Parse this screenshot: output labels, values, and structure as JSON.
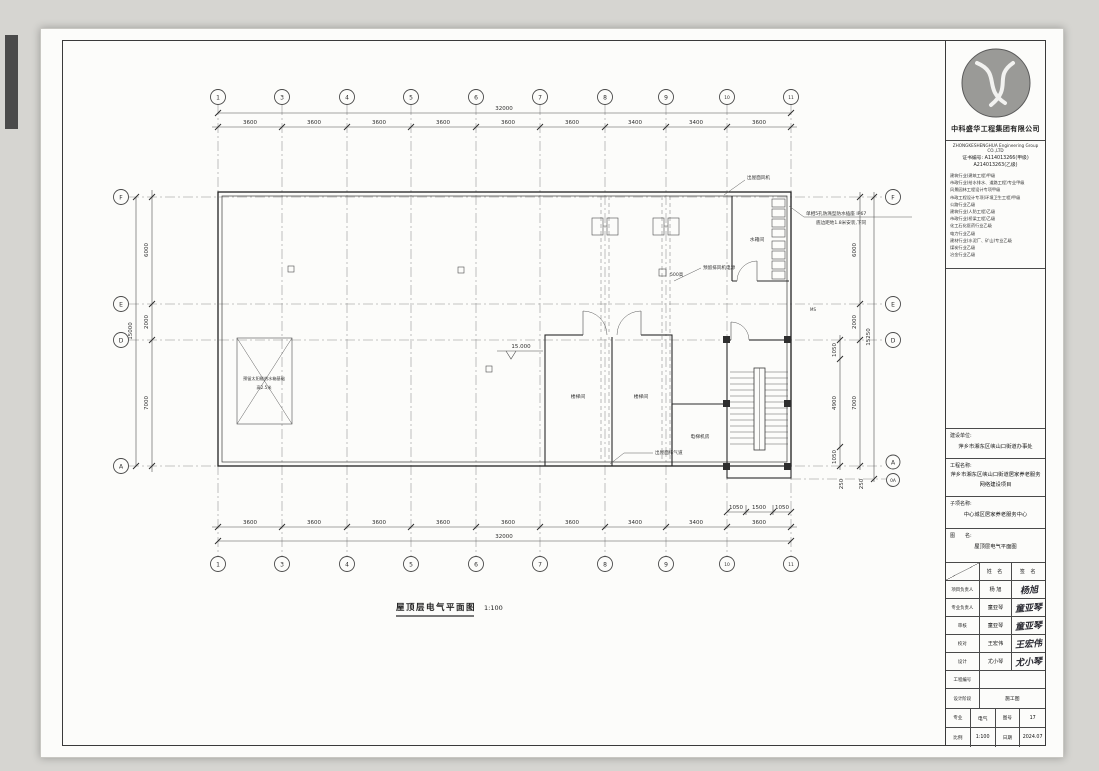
{
  "colors": {
    "paper": "#fcfcfa",
    "background": "#d6d5d1",
    "line": "#3a3a3a"
  },
  "title_block": {
    "company_cn": "中科盛华工程集团有限公司",
    "company_en": "ZHONGKESHENGHUA Engineering Group CO.,LTD",
    "cert_line1": "证书编号: A114013266(甲级)",
    "cert_line2": "A214013263(乙级)",
    "qualifications": [
      "建筑行业(建筑工程)甲级",
      "市政行业(给水排水、道路工程)专业甲级",
      "风景园林工程设计专项甲级",
      "市政工程设计专项(环境卫生工程)甲级",
      "公路行业乙级",
      "建筑行业(人防工程)乙级",
      "市政行业(桥梁工程)乙级",
      "化工石化医药行业乙级",
      "电力行业乙级",
      "建材行业(水泥厂、矿山)专业乙级",
      "煤炭行业乙级",
      "冶金行业乙级"
    ],
    "owner_label": "建设单位:",
    "owner": "萍乡市湘东区峡山口街道办事处",
    "project_label": "工程名称:",
    "project_line1": "萍乡市湘东区峡山口街道居家养老服务",
    "project_line2": "网络建设项目",
    "sub_label": "子项名称:",
    "sub": "中心城区居家养老服务中心",
    "fig_label": "图　　名:",
    "fig": "屋顶层电气平面图",
    "col_name": "姓  名",
    "col_sign": "签  名",
    "rows": [
      {
        "role": "项目负责人",
        "name": "杨  旭",
        "sig": "杨旭"
      },
      {
        "role": "专业负责人",
        "name": "童亚琴",
        "sig": "童亚琴"
      },
      {
        "role": "审核",
        "name": "童亚琴",
        "sig": "童亚琴"
      },
      {
        "role": "校对",
        "name": "王宏伟",
        "sig": "王宏伟"
      },
      {
        "role": "设计",
        "name": "尤小琴",
        "sig": "尤小琴"
      }
    ],
    "project_no_label": "工程编号",
    "project_no": "",
    "stage_label": "设计阶段",
    "stage": "施工图",
    "major_label": "专业",
    "major": "电气",
    "fig_no_label": "图号",
    "fig_no": "17",
    "scale_label": "比例",
    "scale": "1:100",
    "date_label": "日期",
    "date": "2024.07"
  },
  "plan": {
    "title": "屋顶层电气平面图",
    "title_scale": "1:100",
    "bubbles_cols": [
      "1",
      "3",
      "4",
      "5",
      "6",
      "7",
      "8",
      "9",
      "10",
      "11"
    ],
    "bubbles_left": [
      "F",
      "E",
      "D",
      "A"
    ],
    "bubbles_right": [
      "F",
      "E",
      "D",
      "A",
      "0A"
    ],
    "dims_top": [
      "3600",
      "3600",
      "3600",
      "3600",
      "3600",
      "3600",
      "3400",
      "3400",
      "3600"
    ],
    "top_total": "32000",
    "dims_bottom": [
      "3600",
      "3600",
      "3600",
      "3600",
      "3600",
      "3600",
      "3400",
      "3400",
      "3600"
    ],
    "bottom_total": "32000",
    "dims_bottom_sub": [
      "1050",
      "1500",
      "1050"
    ],
    "dims_left": [
      "6000",
      "2000",
      "7000"
    ],
    "left_total": "15000",
    "dims_right": [
      "6000",
      "2000",
      "7000"
    ],
    "right_total": "15250",
    "dims_right_inner": [
      "1050",
      "4900",
      "1050"
    ],
    "dims_right_bottom": [
      "250",
      "250"
    ],
    "rooms": {
      "tank": "水箱间",
      "stair1": "楼梯间",
      "stair2": "楼梯间",
      "elev": "电梯机房"
    },
    "annotations": {
      "socket1": "单相5孔防溅型防水插座 IP67",
      "socket2": "底边距地1.8米安装,下同",
      "roof_fan": "出屋面风机",
      "fan_power": "预留排风机电源",
      "h500": "500高",
      "elev_15": "15.000",
      "base1": "预留太阳能热水箱基础",
      "base2": "高2.5米",
      "vent": "出屋面排气道",
      "ms": "MS"
    }
  }
}
